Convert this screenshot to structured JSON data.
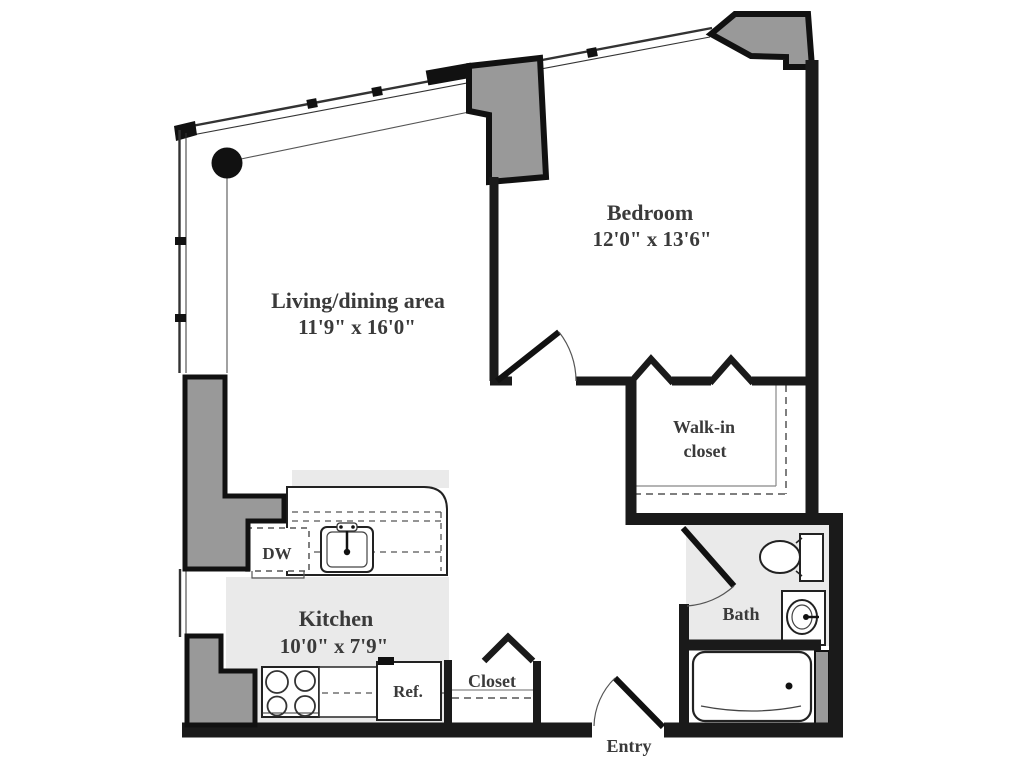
{
  "title": "One-bedroom apartment floor plan",
  "colors": {
    "wall": "#1a1a1a",
    "structure_gray": "#999999",
    "floor_gray": "#eaeaea",
    "thin_line": "#444444",
    "text": "#3a3a3a"
  },
  "rooms": {
    "living": {
      "name": "Living/dining area",
      "dims": "11'9\" x 16'0\""
    },
    "bedroom": {
      "name": "Bedroom",
      "dims": "12'0\" x 13'6\""
    },
    "kitchen": {
      "name": "Kitchen",
      "dims": "10'0\" x 7'9\""
    },
    "walk_in_closet": {
      "line1": "Walk-in",
      "line2": "closet"
    },
    "bath": {
      "name": "Bath"
    },
    "closet": {
      "name": "Closet"
    },
    "entry": {
      "name": "Entry"
    }
  },
  "appliances": {
    "dishwasher": "DW",
    "refrigerator": "Ref."
  },
  "fixtures": [
    "column-round",
    "column-structural-left",
    "column-structural-top-right",
    "kitchen-sink",
    "stove-4-burner",
    "toilet",
    "vanity-sink",
    "bathtub"
  ]
}
